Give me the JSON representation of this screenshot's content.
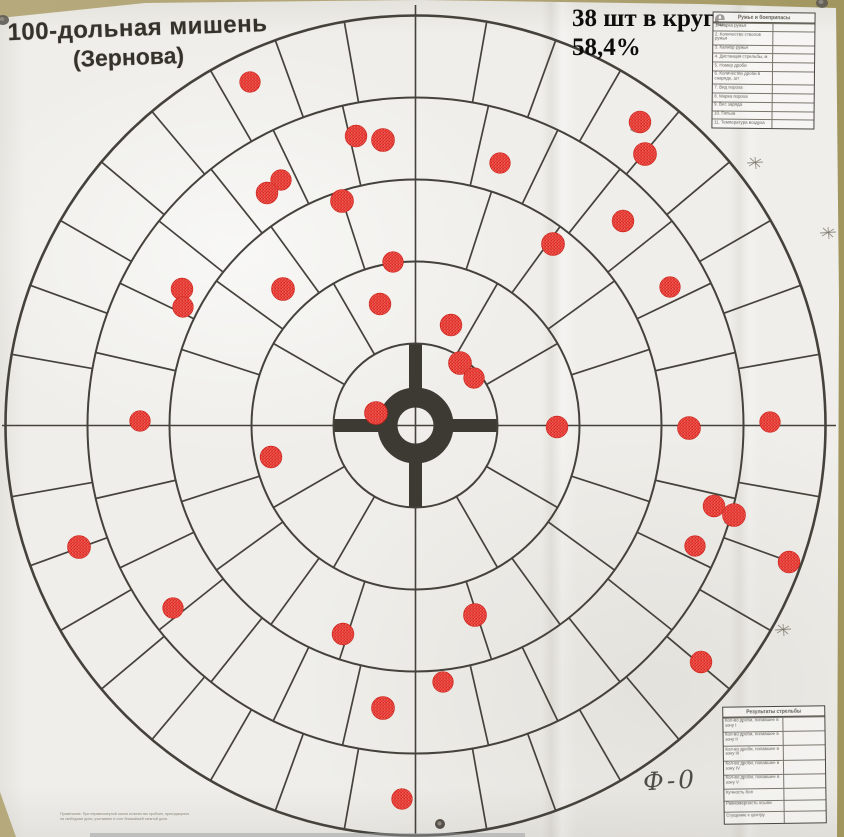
{
  "photo": {
    "background_color": "#b0a476",
    "paper_color": "#efeeea",
    "bottom_strip_color": "#989c9d"
  },
  "title": {
    "line1": "100-дольная мишень",
    "line2": "(Зернова)"
  },
  "annotation": {
    "hits_in_circle": "38 шт в круге",
    "percentage": "58,4%"
  },
  "handwriting": {
    "mark": "Ф-0"
  },
  "gun_table": {
    "title": "Ружье и боеприпасы",
    "rows": [
      "1. Марка ружья",
      "2. Количество стволов ружья",
      "3. Калибр ружья",
      "4. Дистанция стрельбы, м",
      "5. Номер дроби",
      "6. Количество дроби в снаряде, шт",
      "7. Вид пороха",
      "8. Марка пороха",
      "9. Вес заряда",
      "10. Гильза",
      "11. Температура воздуха"
    ]
  },
  "results_table": {
    "title": "Результаты стрельбы",
    "rows": [
      "Кол-во дроби, попавшее в зону I",
      "Кол-во дроби, попавшее в зону II",
      "Кол-во дроби, попавшее в зону III",
      "Кол-во дроби, попавшее в зону IV",
      "Кол-во дроби, попавшее в зону V",
      "Кучность боя",
      "Равномерность осыпи",
      "Сгущение к центру"
    ]
  },
  "footnote": {
    "line1": "Примечание. При неравномерной осыпи количество пробоин, приходящееся",
    "line2": "на свободные доли, учитывают в счет ближайшей занятой доли."
  },
  "target": {
    "center": {
      "x": 415.5,
      "y": 425.5
    },
    "ring_radii": [
      38,
      82,
      164,
      246,
      328,
      410
    ],
    "inner_hole_radius": 18,
    "sectors_per_ring": [
      4,
      12,
      20,
      28,
      36
    ],
    "total_parts": 100,
    "hit_count": 38,
    "coverage_percent": "58,4%",
    "hit_radius": 10.3,
    "hit_color": "#e5322b",
    "line_color": "#45423c",
    "cross_color": "#3d3a34",
    "hits": [
      [
        250,
        82
      ],
      [
        356,
        136
      ],
      [
        383,
        140
      ],
      [
        281,
        180
      ],
      [
        267,
        193
      ],
      [
        342,
        201
      ],
      [
        393,
        262
      ],
      [
        182,
        289
      ],
      [
        283,
        289
      ],
      [
        183,
        307
      ],
      [
        380,
        304
      ],
      [
        376,
        413
      ],
      [
        140,
        421
      ],
      [
        640,
        122
      ],
      [
        645,
        154
      ],
      [
        500,
        163
      ],
      [
        623,
        221
      ],
      [
        553,
        244
      ],
      [
        670,
        287
      ],
      [
        451,
        325
      ],
      [
        460,
        363
      ],
      [
        474,
        378
      ],
      [
        271,
        457
      ],
      [
        79,
        547
      ],
      [
        173,
        608
      ],
      [
        343,
        634
      ],
      [
        383,
        708
      ],
      [
        402,
        799
      ],
      [
        557,
        427
      ],
      [
        689,
        428
      ],
      [
        770,
        422
      ],
      [
        714,
        506
      ],
      [
        734,
        515
      ],
      [
        695,
        546
      ],
      [
        789,
        562
      ],
      [
        475,
        615
      ],
      [
        443,
        682
      ],
      [
        701,
        662
      ]
    ],
    "ghost_ring_hits": [
      [
        640,
        122
      ],
      [
        734,
        515
      ]
    ],
    "unmarked_holes": [
      [
        440,
        824
      ]
    ],
    "pins": [
      [
        3,
        20
      ],
      [
        822,
        3
      ]
    ],
    "pencil_marks": [
      [
        755,
        163
      ],
      [
        828,
        233
      ],
      [
        783,
        630
      ]
    ]
  }
}
